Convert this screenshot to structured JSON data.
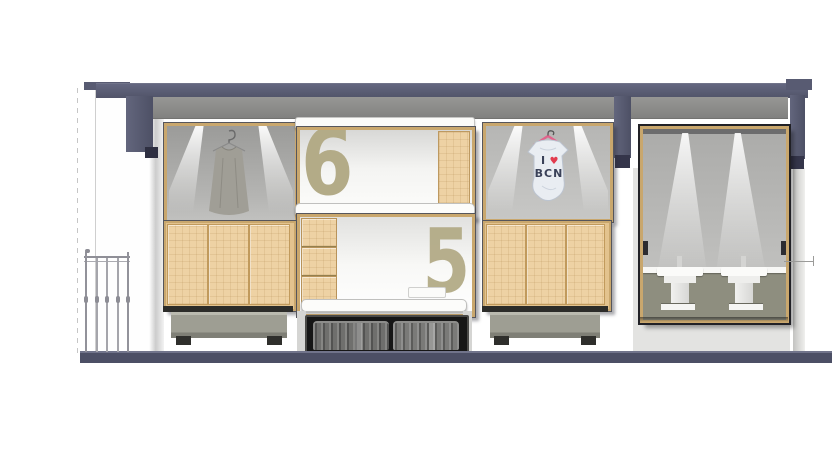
{
  "drawing": {
    "type": "shop-interior-section-elevation",
    "bunks": {
      "upper_number": "6",
      "lower_number": "5"
    },
    "tshirt": {
      "letter": "I",
      "heart": "♥",
      "city": "BCN"
    },
    "palette": {
      "structure_navy": "#585b72",
      "soffit_gray": "#8b8b89",
      "wood_light": "#eed2a4",
      "wood_frame": "#c9a76d",
      "numeral_khaki": "#b3ab87",
      "plinth_gray": "#9e9e93",
      "floor_navy": "#4c4f65",
      "bath_wall_olive": "#8e8e7f",
      "heart_red": "#e23b4e",
      "dress_gray": "#a09e96",
      "tshirt_blue": "#e9edf2"
    }
  }
}
